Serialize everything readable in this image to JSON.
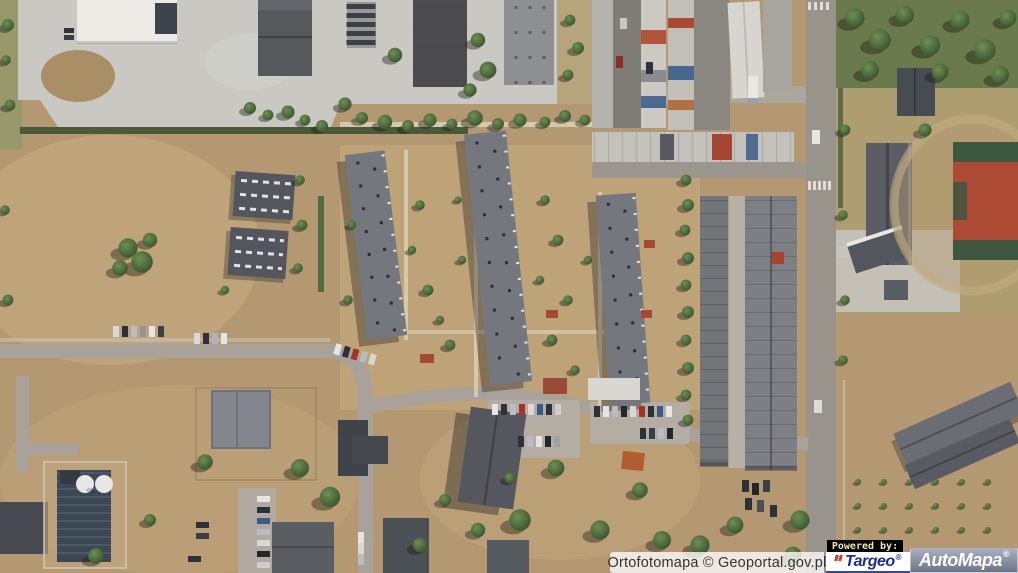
{
  "map": {
    "view_type": "aerial-orthophoto",
    "visible_features": [
      "industrial-halls",
      "warehouse-yard",
      "garage-rows",
      "container-storage",
      "apartment-blocks",
      "residential-houses",
      "parking-lots-with-cars",
      "access-roads",
      "pedestrian-crossing",
      "dry-grass-fields",
      "tree-clusters",
      "school-buildings",
      "sports-court",
      "running-track",
      "storage-tanks-facility"
    ]
  },
  "attribution": {
    "source_text": "Ortofotomapa © Geoportal.gov.pl",
    "text_color": "#333333",
    "background": "rgba(255,255,255,0.78)"
  },
  "branding": {
    "powered_by_label": "Powered by:",
    "powered_by_text_color": "#efe8a0",
    "powered_by_background": "#000000",
    "targeo": {
      "name": "Targeo",
      "registered_mark": "®",
      "text_color": "#1c2e91",
      "mark_color": "#e03222",
      "background": "#ffffff"
    },
    "automapa": {
      "name": "AutoMapa",
      "registered_mark": "®",
      "text_color": "#ffffff",
      "background_top": "#a8aec2",
      "background_bottom": "#6e7488"
    }
  }
}
